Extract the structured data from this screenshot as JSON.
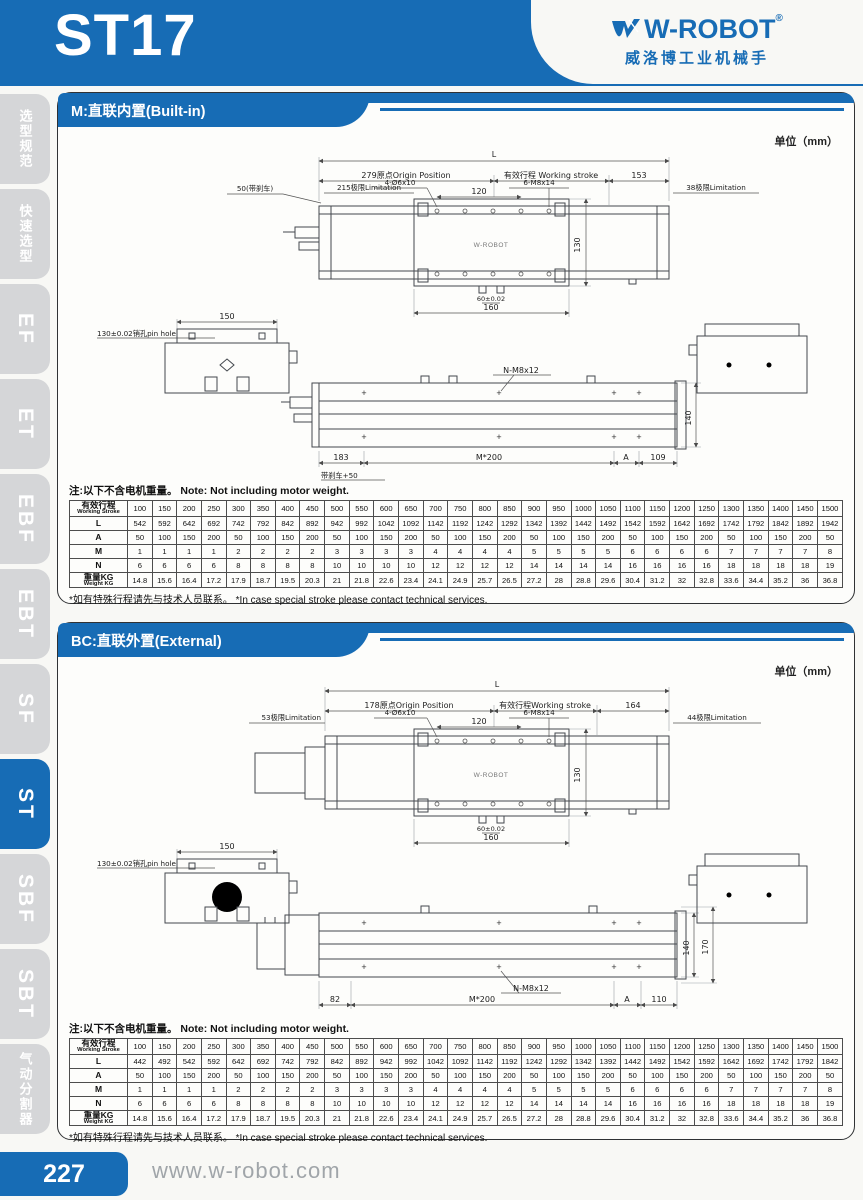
{
  "page": {
    "model": "ST17",
    "brand": {
      "name": "W-ROBOT",
      "reg": "®",
      "tagline": "威洛博工业机械手"
    },
    "footer": {
      "page_number": "227",
      "website": "www.w-robot.com"
    }
  },
  "sidebar": {
    "items": [
      {
        "label": "选型规范",
        "active": false
      },
      {
        "label": "快速选型",
        "active": false
      },
      {
        "label": "EF",
        "active": false
      },
      {
        "label": "ET",
        "active": false
      },
      {
        "label": "EBF",
        "active": false
      },
      {
        "label": "EBT",
        "active": false
      },
      {
        "label": "SF",
        "active": false
      },
      {
        "label": "ST",
        "active": true
      },
      {
        "label": "SBF",
        "active": false
      },
      {
        "label": "SBT",
        "active": false
      },
      {
        "label": "气动分割器",
        "active": false
      }
    ]
  },
  "section1": {
    "title": "M:直联内置(Built-in)",
    "unit": "单位（mm）",
    "note_top": "注:以下不含电机重量。 Note: Not including motor weight.",
    "note_bottom": "*如有特殊行程请先与技术人员联系。 *In case special stroke please contact technical services.",
    "dims": {
      "overall": "L",
      "origin": "279原点Origin Position",
      "stroke": "有效行程 Working stroke",
      "right_seg": "153",
      "brake": "50(带刹车)",
      "limit_left": "215极限Limitation",
      "limit_right": "38极限Limitation",
      "holes": "4-Ø6x10",
      "pitch": "120",
      "screws": "6-M8x14",
      "width": "130",
      "pin_offset": "60±0.02",
      "plate": "160",
      "base": "150",
      "pin_hole": "130±0.02销孔pin hole",
      "side_screws": "N-M8x12",
      "height": "140",
      "left_end": "183",
      "pitch_run": "M*200",
      "a": "A",
      "right_end": "109",
      "brake_add": "带刹车+50",
      "mini_logo": "W-ROBOT"
    },
    "table": {
      "rows": [
        {
          "label": "有效行程",
          "label2": "Working Stroke",
          "values": [
            "100",
            "150",
            "200",
            "250",
            "300",
            "350",
            "400",
            "450",
            "500",
            "550",
            "600",
            "650",
            "700",
            "750",
            "800",
            "850",
            "900",
            "950",
            "1000",
            "1050",
            "1100",
            "1150",
            "1200",
            "1250",
            "1300",
            "1350",
            "1400",
            "1450",
            "1500"
          ]
        },
        {
          "label": "L",
          "values": [
            "542",
            "592",
            "642",
            "692",
            "742",
            "792",
            "842",
            "892",
            "942",
            "992",
            "1042",
            "1092",
            "1142",
            "1192",
            "1242",
            "1292",
            "1342",
            "1392",
            "1442",
            "1492",
            "1542",
            "1592",
            "1642",
            "1692",
            "1742",
            "1792",
            "1842",
            "1892",
            "1942"
          ]
        },
        {
          "label": "A",
          "values": [
            "50",
            "100",
            "150",
            "200",
            "50",
            "100",
            "150",
            "200",
            "50",
            "100",
            "150",
            "200",
            "50",
            "100",
            "150",
            "200",
            "50",
            "100",
            "150",
            "200",
            "50",
            "100",
            "150",
            "200",
            "50",
            "100",
            "150",
            "200",
            "50"
          ]
        },
        {
          "label": "M",
          "values": [
            "1",
            "1",
            "1",
            "1",
            "2",
            "2",
            "2",
            "2",
            "3",
            "3",
            "3",
            "3",
            "4",
            "4",
            "4",
            "4",
            "5",
            "5",
            "5",
            "5",
            "6",
            "6",
            "6",
            "6",
            "7",
            "7",
            "7",
            "7",
            "8"
          ]
        },
        {
          "label": "N",
          "values": [
            "6",
            "6",
            "6",
            "6",
            "8",
            "8",
            "8",
            "8",
            "10",
            "10",
            "10",
            "10",
            "12",
            "12",
            "12",
            "12",
            "14",
            "14",
            "14",
            "14",
            "16",
            "16",
            "16",
            "16",
            "18",
            "18",
            "18",
            "18",
            "19"
          ]
        },
        {
          "label": "重量KG",
          "label2": "Weight KG",
          "values": [
            "14.8",
            "15.6",
            "16.4",
            "17.2",
            "17.9",
            "18.7",
            "19.5",
            "20.3",
            "21",
            "21.8",
            "22.6",
            "23.4",
            "24.1",
            "24.9",
            "25.7",
            "26.5",
            "27.2",
            "28",
            "28.8",
            "29.6",
            "30.4",
            "31.2",
            "32",
            "32.8",
            "33.6",
            "34.4",
            "35.2",
            "36",
            "36.8"
          ]
        }
      ]
    }
  },
  "section2": {
    "title": "BC:直联外置(External)",
    "unit": "单位（mm）",
    "note_top": "注:以下不含电机重量。 Note: Not including motor weight.",
    "note_bottom": "*如有特殊行程请先与技术人员联系。 *In case special stroke please contact technical services.",
    "dims": {
      "overall": "L",
      "origin": "178原点Origin Position",
      "stroke": "有效行程Working stroke",
      "right_seg": "164",
      "limit_left": "53极限Limitation",
      "limit_right": "44极限Limitation",
      "holes": "4-Ø6x10",
      "pitch": "120",
      "screws": "6-M8x14",
      "width": "130",
      "pin_offset": "60±0.02",
      "plate": "160",
      "base": "150",
      "pin_hole": "130±0.02销孔pin hole",
      "side_screws": "N-M8x12",
      "height": "140",
      "height_total": "170",
      "left_end": "82",
      "pitch_run": "M*200",
      "a": "A",
      "right_end": "110",
      "mini_logo": "W-ROBOT"
    },
    "table": {
      "rows": [
        {
          "label": "有效行程",
          "label2": "Working Stroke",
          "values": [
            "100",
            "150",
            "200",
            "250",
            "300",
            "350",
            "400",
            "450",
            "500",
            "550",
            "600",
            "650",
            "700",
            "750",
            "800",
            "850",
            "900",
            "950",
            "1000",
            "1050",
            "1100",
            "1150",
            "1200",
            "1250",
            "1300",
            "1350",
            "1400",
            "1450",
            "1500"
          ]
        },
        {
          "label": "L",
          "values": [
            "442",
            "492",
            "542",
            "592",
            "642",
            "692",
            "742",
            "792",
            "842",
            "892",
            "942",
            "992",
            "1042",
            "1092",
            "1142",
            "1192",
            "1242",
            "1292",
            "1342",
            "1392",
            "1442",
            "1492",
            "1542",
            "1592",
            "1642",
            "1692",
            "1742",
            "1792",
            "1842"
          ]
        },
        {
          "label": "A",
          "values": [
            "50",
            "100",
            "150",
            "200",
            "50",
            "100",
            "150",
            "200",
            "50",
            "100",
            "150",
            "200",
            "50",
            "100",
            "150",
            "200",
            "50",
            "100",
            "150",
            "200",
            "50",
            "100",
            "150",
            "200",
            "50",
            "100",
            "150",
            "200",
            "50"
          ]
        },
        {
          "label": "M",
          "values": [
            "1",
            "1",
            "1",
            "1",
            "2",
            "2",
            "2",
            "2",
            "3",
            "3",
            "3",
            "3",
            "4",
            "4",
            "4",
            "4",
            "5",
            "5",
            "5",
            "5",
            "6",
            "6",
            "6",
            "6",
            "7",
            "7",
            "7",
            "7",
            "8"
          ]
        },
        {
          "label": "N",
          "values": [
            "6",
            "6",
            "6",
            "6",
            "8",
            "8",
            "8",
            "8",
            "10",
            "10",
            "10",
            "10",
            "12",
            "12",
            "12",
            "12",
            "14",
            "14",
            "14",
            "14",
            "16",
            "16",
            "16",
            "16",
            "18",
            "18",
            "18",
            "18",
            "19"
          ]
        },
        {
          "label": "重量KG",
          "label2": "Weight KG",
          "values": [
            "14.8",
            "15.6",
            "16.4",
            "17.2",
            "17.9",
            "18.7",
            "19.5",
            "20.3",
            "21",
            "21.8",
            "22.6",
            "23.4",
            "24.1",
            "24.9",
            "25.7",
            "26.5",
            "27.2",
            "28",
            "28.8",
            "29.6",
            "30.4",
            "31.2",
            "32",
            "32.8",
            "33.6",
            "34.4",
            "35.2",
            "36",
            "36.8"
          ]
        }
      ]
    }
  }
}
